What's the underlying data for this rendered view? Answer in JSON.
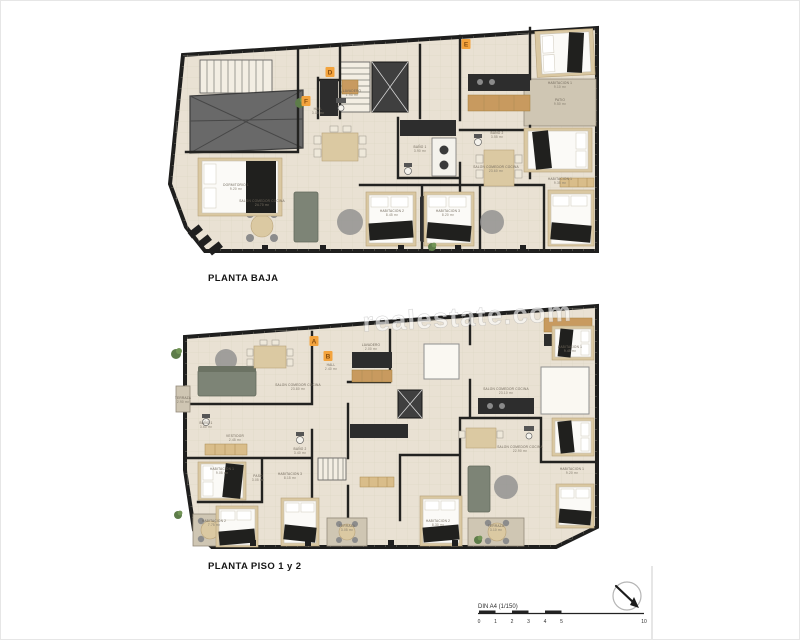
{
  "document": {
    "type": "Architectural floor plan sheet"
  },
  "watermark": {
    "text": "realestate.com"
  },
  "plans": [
    {
      "title": "PLANTA BAJA",
      "markers": [
        "D",
        "E",
        "F"
      ],
      "rooms": [
        {
          "name": "SALON COMEDOR COCINA",
          "area": "24.70 m²"
        },
        {
          "name": "DORMITORIO 1",
          "area": "9.20 m²"
        },
        {
          "name": "BAÑO 1",
          "area": "3.90 m²"
        },
        {
          "name": "HALL",
          "area": "3.10 m²"
        },
        {
          "name": "LAVADERO",
          "area": "1.95 m²"
        },
        {
          "name": "PATIO",
          "area": "9.50 m²"
        },
        {
          "name": "SALON COMEDOR COCINA",
          "area": "23.60 m²"
        },
        {
          "name": "HABITACION 1",
          "area": "9.35 m²"
        },
        {
          "name": "HABITACION 2",
          "area": "8.45 m²"
        },
        {
          "name": "HABITACION 3",
          "area": "8.20 m²"
        },
        {
          "name": "BAÑO 2",
          "area": "3.55 m²"
        },
        {
          "name": "HABITACION 1",
          "area": "9.10 m²"
        }
      ]
    },
    {
      "title": "PLANTA PISO 1 y 2",
      "markers": [
        "A",
        "B"
      ],
      "rooms": [
        {
          "name": "SALON COMEDOR COCINA",
          "area": "23.80 m²"
        },
        {
          "name": "TERRAZA",
          "area": "2.90 m²"
        },
        {
          "name": "HALL",
          "area": "2.40 m²"
        },
        {
          "name": "LAVADERO",
          "area": "2.00 m²"
        },
        {
          "name": "BAÑO 1",
          "area": "3.60 m²"
        },
        {
          "name": "VESTIDOR",
          "area": "2.45 m²"
        },
        {
          "name": "HABITACION 1",
          "area": "9.05 m²"
        },
        {
          "name": "HABITACION 2",
          "area": "7.75 m²"
        },
        {
          "name": "PASO",
          "area": "3.05 m²"
        },
        {
          "name": "HABITACION 3",
          "area": "8.15 m²"
        },
        {
          "name": "BAÑO 2",
          "area": "3.40 m²"
        },
        {
          "name": "SALON COMEDOR COCINA",
          "area": "22.90 m²"
        },
        {
          "name": "HABITACION 1",
          "area": "9.20 m²"
        },
        {
          "name": "TERRAZA",
          "area": "3.05 m²"
        },
        {
          "name": "TERRAZA",
          "area": "3.10 m²"
        },
        {
          "name": "HABITACION 2",
          "area": "8.30 m²"
        },
        {
          "name": "HABITACION 1",
          "area": "9.45 m²"
        },
        {
          "name": "SALON COMEDOR COCINA",
          "area": "23.10 m²"
        }
      ]
    }
  ],
  "scale_bar": {
    "label": "DIN A4 (1/150)",
    "ticks": [
      "0",
      "1",
      "2",
      "3",
      "4",
      "5",
      "10"
    ]
  },
  "compass": {
    "icon": "north-arrow"
  }
}
